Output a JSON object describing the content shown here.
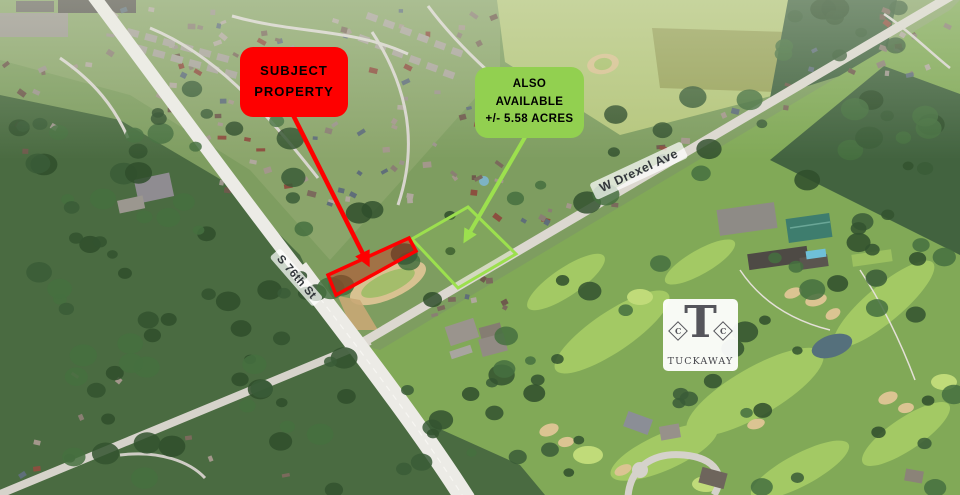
{
  "callouts": {
    "subject": {
      "line1": "SUBJECT",
      "line2": "PROPERTY"
    },
    "available": {
      "line1": "ALSO",
      "line2": "AVAILABLE",
      "line3": "+/- 5.58 ACRES"
    }
  },
  "roads": {
    "s76": "S 76th St",
    "drexel": "W Drexel Ave"
  },
  "logo": {
    "initial": "T",
    "monogram": "C",
    "name": "TUCKAWAY"
  },
  "colors": {
    "subject_red": "#FE0000",
    "available_green": "#92D050",
    "parcel_red": "#FF0000",
    "parcel_green": "#9CE04E"
  }
}
